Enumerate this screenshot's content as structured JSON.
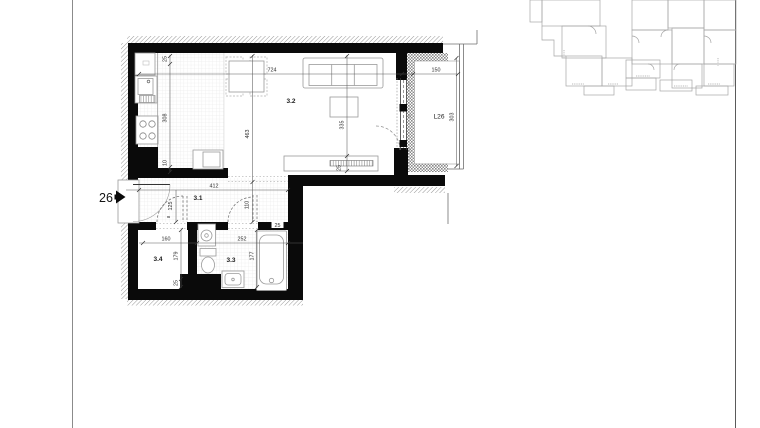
{
  "plan": {
    "apartment_number": "26",
    "room_labels": {
      "hall": "3.1",
      "living": "3.2",
      "bathroom": "3.3",
      "wardrobe": "3.4"
    },
    "balcony": {
      "label": "L26",
      "width": "150",
      "depth": "303",
      "window_marks": [
        "90",
        "58",
        "90"
      ]
    },
    "dims": {
      "living_width": "724",
      "kitchen_top": "25",
      "kitchen_run": "308",
      "kitchen_bottom": "10",
      "living_height": "463",
      "living_height_right": "335",
      "bench_depth": "25",
      "hall_width": "412",
      "hall_height": "125",
      "hall_gap": "8",
      "hall_door_height": "110",
      "wardrobe_width": "160",
      "bath_width": "252",
      "bath_wall": "25",
      "wardrobe_height": "179",
      "wardrobe_bottom": "25",
      "bath_height": "177"
    }
  }
}
